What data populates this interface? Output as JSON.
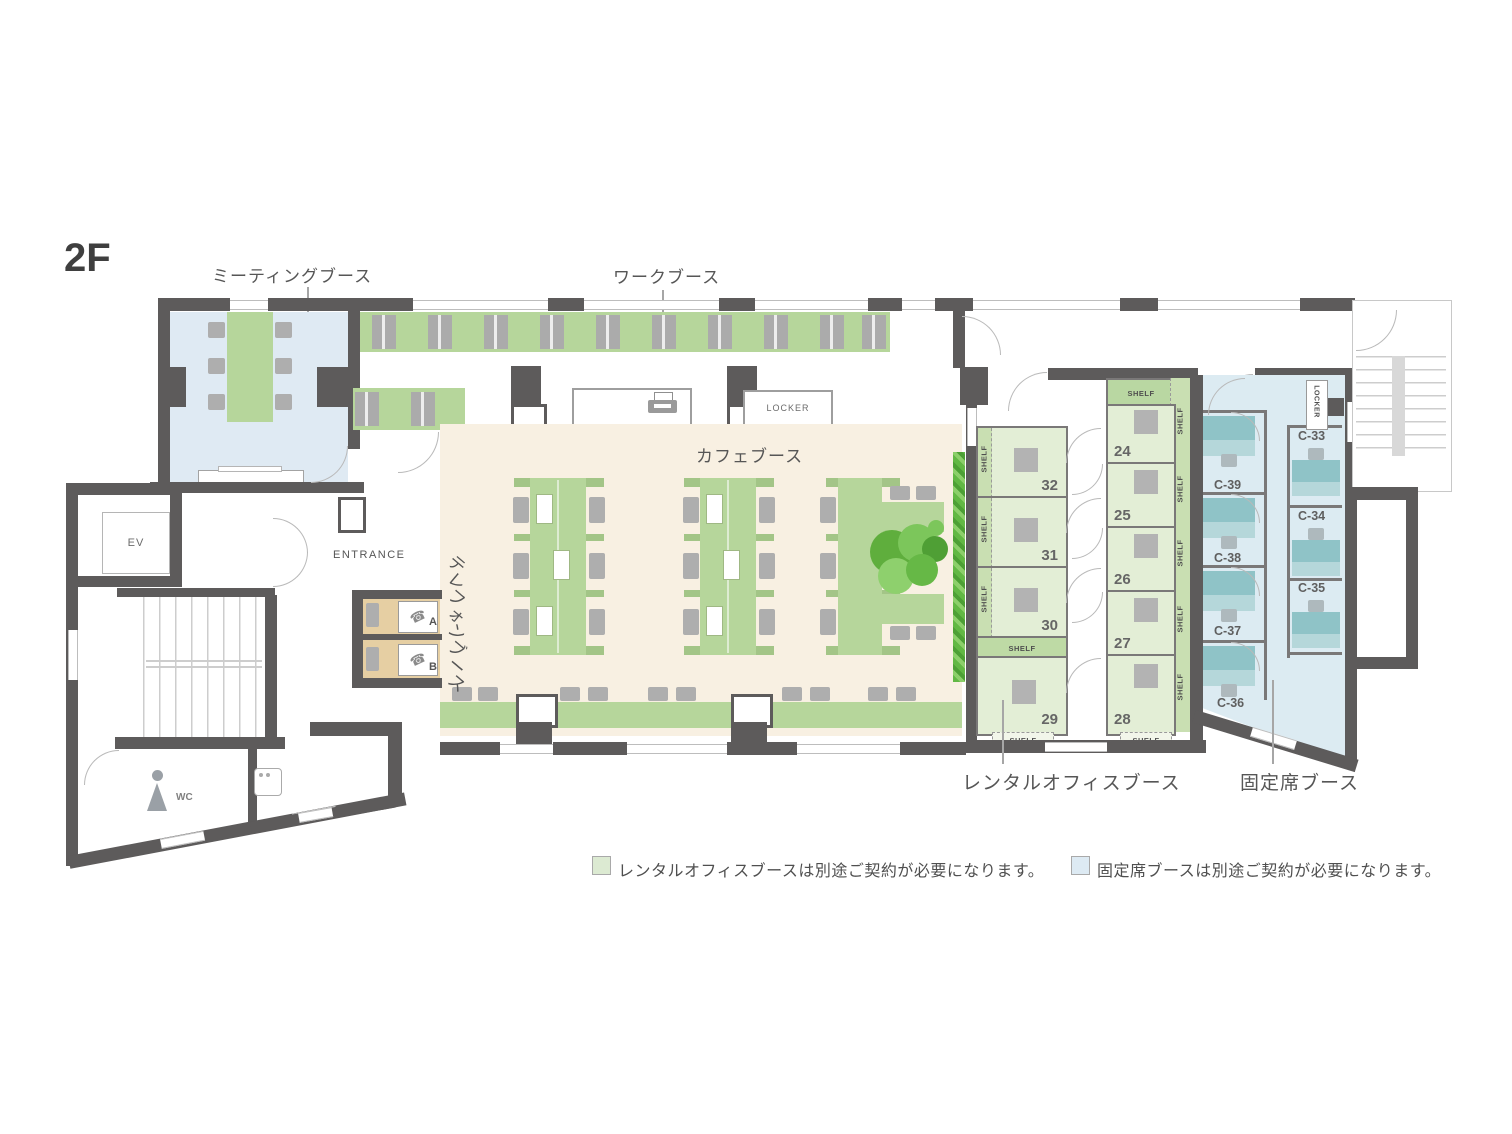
{
  "floor_label": "2F",
  "area_labels": {
    "meeting": "ミーティングブース",
    "work": "ワークブース",
    "cafe": "カフェブース",
    "phone": "テレフォンブース",
    "rental": "レンタルオフィスブース",
    "fixed": "固定席ブース"
  },
  "room_labels": {
    "entrance": "ENTRANCE",
    "ev": "EV",
    "wc": "WC",
    "locker": "LOCKER",
    "shelf": "SHELF"
  },
  "phone_booths": [
    "A",
    "B"
  ],
  "rental_booths": {
    "left": [
      "32",
      "31",
      "30",
      "29"
    ],
    "right": [
      "24",
      "25",
      "26",
      "27",
      "28"
    ]
  },
  "fixed_booths": {
    "left": [
      "C-39",
      "C-38",
      "C-37",
      "C-36"
    ],
    "right": [
      "C-33",
      "C-34",
      "C-35"
    ]
  },
  "legend": {
    "rental": {
      "color": "#dcead2",
      "text": "レンタルオフィスブースは別途ご契約が必要になります。"
    },
    "fixed": {
      "color": "#ddeaf3",
      "text": "固定席ブースは別途ご契約が必要になります。"
    }
  },
  "icons": {
    "phone": "☎"
  },
  "colors": {
    "wall": "#5d5b5b",
    "meeting_room": "#dfeaf3",
    "desk_green": "#b6d69b",
    "desk_green_dark": "#a3c587",
    "booth_cell_green": "#e3eed6",
    "shelf_green": "#c9dfb2",
    "cafe_floor": "#f8f0e2",
    "phone_booth_tan": "#e6cfa3",
    "fixed_floor": "#dcebf2",
    "fixed_desk_teal": "#8fc3c7",
    "chair_gray": "#aeaeae",
    "plant_green": "#6abf49"
  }
}
